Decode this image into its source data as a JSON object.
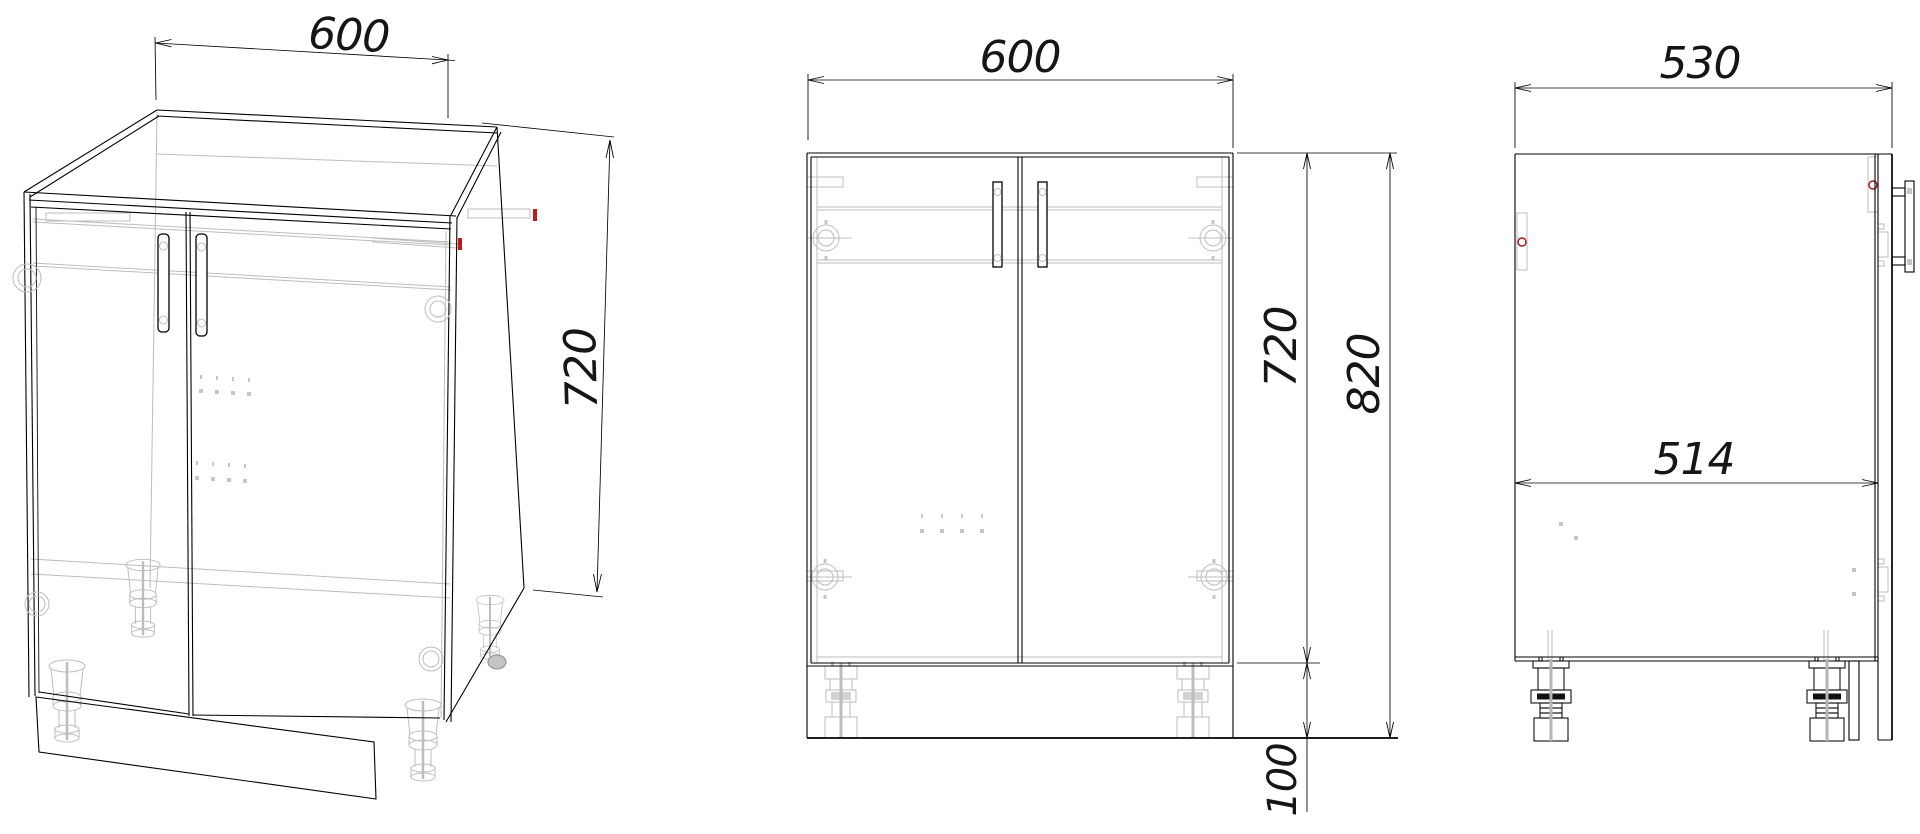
{
  "views": {
    "isometric": {
      "width_mm": "600",
      "height_mm": "720"
    },
    "front": {
      "width_mm": "600",
      "carcass_height_mm": "720",
      "total_height_mm": "820",
      "leg_height_mm": "100"
    },
    "side": {
      "depth_mm": "530",
      "inner_depth_mm": "514"
    }
  },
  "colors": {
    "outline": "#000000",
    "hidden_detail": "#bdbdbd",
    "marker_red": "#c01a1a",
    "background": "#ffffff"
  }
}
